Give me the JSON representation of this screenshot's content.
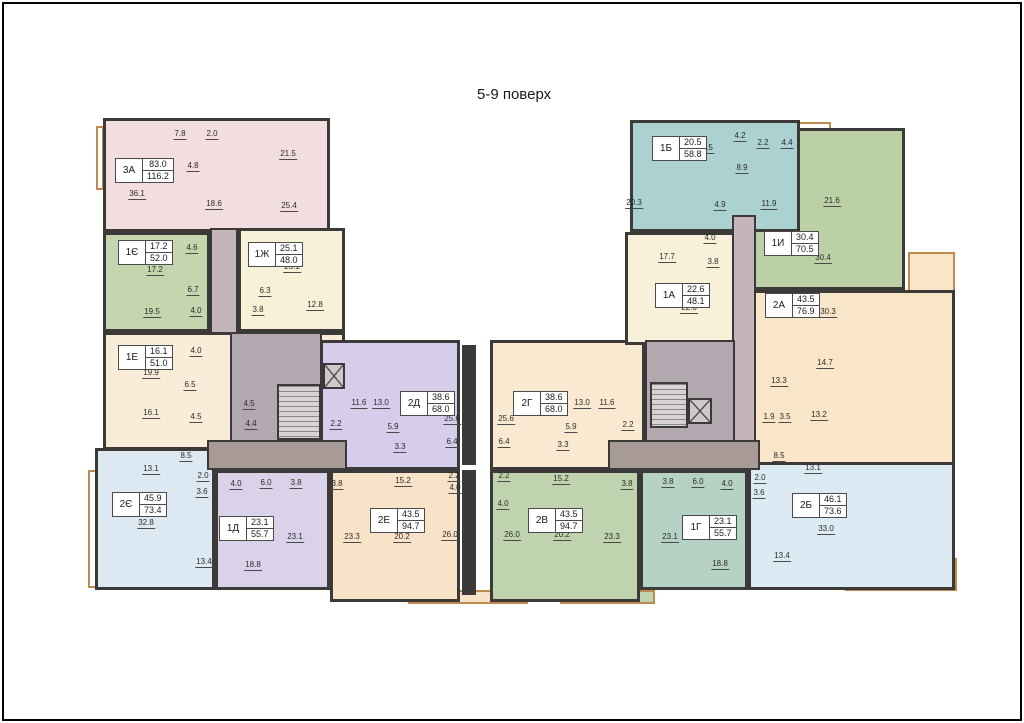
{
  "title": "5-9 поверх",
  "wall_color": "#3c3a39",
  "balcony_color": "#c08a4e",
  "apartments": [
    {
      "id": "3a",
      "code": "3А",
      "living_area": "83.0",
      "total_area": "116.2",
      "color": "#f2dede",
      "rect": [
        103,
        118,
        227,
        114
      ],
      "label_pos": [
        115,
        158
      ],
      "rooms": [
        {
          "v": "7.8",
          "x": 180,
          "y": 134
        },
        {
          "v": "2.0",
          "x": 212,
          "y": 134
        },
        {
          "v": "21.5",
          "x": 288,
          "y": 154
        },
        {
          "v": "4.8",
          "x": 193,
          "y": 166
        },
        {
          "v": "36.1",
          "x": 137,
          "y": 194
        },
        {
          "v": "18.6",
          "x": 214,
          "y": 204
        },
        {
          "v": "25.4",
          "x": 289,
          "y": 206
        }
      ]
    },
    {
      "id": "1ie",
      "code": "1Є",
      "living_area": "17.2",
      "total_area": "52.0",
      "color": "#c3d6ad",
      "rect": [
        103,
        232,
        107,
        100
      ],
      "label_pos": [
        118,
        240
      ],
      "rooms": [
        {
          "v": "4.6",
          "x": 192,
          "y": 248
        },
        {
          "v": "17.2",
          "x": 155,
          "y": 270
        },
        {
          "v": "6.7",
          "x": 193,
          "y": 290
        },
        {
          "v": "19.5",
          "x": 152,
          "y": 312
        },
        {
          "v": "4.0",
          "x": 196,
          "y": 311
        }
      ]
    },
    {
      "id": "1zh",
      "code": "1Ж",
      "living_area": "25.1",
      "total_area": "48.0",
      "color": "#f7f1d7",
      "rect": [
        238,
        228,
        107,
        104
      ],
      "label_pos": [
        248,
        242
      ],
      "rooms": [
        {
          "v": "25.1",
          "x": 292,
          "y": 267
        },
        {
          "v": "6.3",
          "x": 265,
          "y": 291
        },
        {
          "v": "3.8",
          "x": 258,
          "y": 310
        },
        {
          "v": "12.8",
          "x": 315,
          "y": 305
        }
      ]
    },
    {
      "id": "1e",
      "code": "1Е",
      "living_area": "16.1",
      "total_area": "51.0",
      "color": "#f9edda",
      "rect": [
        103,
        332,
        242,
        118
      ],
      "label_pos": [
        118,
        345
      ],
      "rooms": [
        {
          "v": "4.0",
          "x": 196,
          "y": 351
        },
        {
          "v": "19.9",
          "x": 151,
          "y": 373
        },
        {
          "v": "6.5",
          "x": 190,
          "y": 385
        },
        {
          "v": "16.1",
          "x": 151,
          "y": 413
        },
        {
          "v": "4.5",
          "x": 196,
          "y": 417
        }
      ]
    },
    {
      "id": "2ie",
      "code": "2Є",
      "living_area": "45.9",
      "total_area": "73.4",
      "color": "#dce8f2",
      "rect": [
        95,
        448,
        120,
        142
      ],
      "label_pos": [
        112,
        492
      ],
      "rooms": [
        {
          "v": "8.5",
          "x": 186,
          "y": 456
        },
        {
          "v": "13.1",
          "x": 151,
          "y": 469
        },
        {
          "v": "2.0",
          "x": 203,
          "y": 476
        },
        {
          "v": "3.6",
          "x": 202,
          "y": 492
        },
        {
          "v": "32.8",
          "x": 146,
          "y": 523
        },
        {
          "v": "13.4",
          "x": 204,
          "y": 562
        }
      ]
    },
    {
      "id": "1d",
      "code": "1Д",
      "living_area": "23.1",
      "total_area": "55.7",
      "color": "#d9d2e9",
      "rect": [
        215,
        470,
        115,
        120
      ],
      "label_pos": [
        219,
        516
      ],
      "rooms": [
        {
          "v": "4.0",
          "x": 236,
          "y": 484
        },
        {
          "v": "6.0",
          "x": 266,
          "y": 483
        },
        {
          "v": "3.8",
          "x": 296,
          "y": 483
        },
        {
          "v": "23.1",
          "x": 295,
          "y": 537
        },
        {
          "v": "18.8",
          "x": 253,
          "y": 565
        }
      ]
    },
    {
      "id": "2e",
      "code": "2Е",
      "living_area": "43.5",
      "total_area": "94.7",
      "color": "#f8e2c8",
      "rect": [
        330,
        470,
        130,
        132
      ],
      "label_pos": [
        370,
        508
      ],
      "rooms": [
        {
          "v": "3.8",
          "x": 337,
          "y": 484
        },
        {
          "v": "15.2",
          "x": 403,
          "y": 481
        },
        {
          "v": "2.2",
          "x": 454,
          "y": 476
        },
        {
          "v": "4.0",
          "x": 455,
          "y": 488
        },
        {
          "v": "23.3",
          "x": 352,
          "y": 537
        },
        {
          "v": "20.2",
          "x": 402,
          "y": 537
        },
        {
          "v": "26.0",
          "x": 450,
          "y": 535
        }
      ]
    },
    {
      "id": "2d",
      "code": "2Д",
      "living_area": "38.6",
      "total_area": "68.0",
      "color": "#d5cdea",
      "rect": [
        320,
        340,
        140,
        130
      ],
      "label_pos": [
        400,
        391
      ],
      "rooms": [
        {
          "v": "11.6",
          "x": 359,
          "y": 403
        },
        {
          "v": "13.0",
          "x": 381,
          "y": 403
        },
        {
          "v": "25.6",
          "x": 452,
          "y": 419
        },
        {
          "v": "5.9",
          "x": 393,
          "y": 427
        },
        {
          "v": "3.3",
          "x": 400,
          "y": 447
        },
        {
          "v": "6.4",
          "x": 452,
          "y": 442
        }
      ]
    },
    {
      "id": "2g",
      "code": "2Г",
      "living_area": "38.6",
      "total_area": "68.0",
      "color": "#f9e9d0",
      "rect": [
        490,
        340,
        155,
        130
      ],
      "label_pos": [
        513,
        391
      ],
      "rooms": [
        {
          "v": "25.6",
          "x": 506,
          "y": 419
        },
        {
          "v": "13.0",
          "x": 582,
          "y": 403
        },
        {
          "v": "11.6",
          "x": 607,
          "y": 403
        },
        {
          "v": "5.9",
          "x": 571,
          "y": 427
        },
        {
          "v": "6.4",
          "x": 504,
          "y": 442
        },
        {
          "v": "3.3",
          "x": 563,
          "y": 445
        }
      ]
    },
    {
      "id": "2v",
      "code": "2В",
      "living_area": "43.5",
      "total_area": "94.7",
      "color": "#bed3ae",
      "rect": [
        490,
        470,
        150,
        132
      ],
      "label_pos": [
        528,
        508
      ],
      "rooms": [
        {
          "v": "2.2",
          "x": 504,
          "y": 476
        },
        {
          "v": "4.0",
          "x": 503,
          "y": 504
        },
        {
          "v": "15.2",
          "x": 561,
          "y": 479
        },
        {
          "v": "26.0",
          "x": 512,
          "y": 535
        },
        {
          "v": "20.2",
          "x": 562,
          "y": 535
        },
        {
          "v": "23.3",
          "x": 612,
          "y": 537
        },
        {
          "v": "3.8",
          "x": 627,
          "y": 484
        }
      ]
    },
    {
      "id": "1g",
      "code": "1Г",
      "living_area": "23.1",
      "total_area": "55.7",
      "color": "#b5d2c4",
      "rect": [
        640,
        470,
        108,
        120
      ],
      "label_pos": [
        682,
        515
      ],
      "rooms": [
        {
          "v": "3.8",
          "x": 668,
          "y": 482
        },
        {
          "v": "6.0",
          "x": 698,
          "y": 482
        },
        {
          "v": "4.0",
          "x": 727,
          "y": 484
        },
        {
          "v": "23.1",
          "x": 670,
          "y": 537
        },
        {
          "v": "18.8",
          "x": 720,
          "y": 564
        }
      ]
    },
    {
      "id": "2b",
      "code": "2Б",
      "living_area": "46.1",
      "total_area": "73.6",
      "color": "#dcebf3",
      "rect": [
        748,
        452,
        207,
        138
      ],
      "label_pos": [
        792,
        493
      ],
      "rooms": [
        {
          "v": "8.5",
          "x": 779,
          "y": 456
        },
        {
          "v": "13.1",
          "x": 813,
          "y": 468
        },
        {
          "v": "2.0",
          "x": 760,
          "y": 478
        },
        {
          "v": "3.6",
          "x": 759,
          "y": 493
        },
        {
          "v": "33.0",
          "x": 826,
          "y": 529
        },
        {
          "v": "13.4",
          "x": 782,
          "y": 556
        }
      ]
    },
    {
      "id": "2a",
      "code": "2А",
      "living_area": "43.5",
      "total_area": "76.9",
      "color": "#f9e6c9",
      "rect": [
        748,
        290,
        207,
        175
      ],
      "label_pos": [
        765,
        293
      ],
      "rooms": [
        {
          "v": "30.3",
          "x": 828,
          "y": 312
        },
        {
          "v": "14.7",
          "x": 825,
          "y": 363
        },
        {
          "v": "13.3",
          "x": 779,
          "y": 381
        },
        {
          "v": "1.9",
          "x": 769,
          "y": 417
        },
        {
          "v": "3.5",
          "x": 785,
          "y": 417
        },
        {
          "v": "13.2",
          "x": 819,
          "y": 415
        }
      ]
    },
    {
      "id": "1a",
      "code": "1А",
      "living_area": "22.6",
      "total_area": "48.1",
      "color": "#f8f0d9",
      "rect": [
        625,
        232,
        123,
        113
      ],
      "label_pos": [
        655,
        283
      ],
      "rooms": [
        {
          "v": "17.7",
          "x": 667,
          "y": 257
        },
        {
          "v": "4.0",
          "x": 710,
          "y": 238
        },
        {
          "v": "3.8",
          "x": 713,
          "y": 262
        },
        {
          "v": "22.6",
          "x": 689,
          "y": 308
        }
      ]
    },
    {
      "id": "1i",
      "code": "1И",
      "living_area": "30.4",
      "total_area": "70.5",
      "color": "#bcd0a6",
      "rect": [
        748,
        128,
        157,
        162
      ],
      "label_pos": [
        764,
        231
      ],
      "rooms": [
        {
          "v": "2.2",
          "x": 763,
          "y": 143
        },
        {
          "v": "4.4",
          "x": 787,
          "y": 143
        },
        {
          "v": "11.9",
          "x": 769,
          "y": 204
        },
        {
          "v": "21.6",
          "x": 832,
          "y": 201
        },
        {
          "v": "30.4",
          "x": 823,
          "y": 258
        }
      ]
    },
    {
      "id": "1b",
      "code": "1Б",
      "living_area": "20.5",
      "total_area": "58.8",
      "color": "#abd1d1",
      "rect": [
        630,
        120,
        170,
        112
      ],
      "label_pos": [
        652,
        136
      ],
      "rooms": [
        {
          "v": "20.5",
          "x": 705,
          "y": 148
        },
        {
          "v": "4.2",
          "x": 740,
          "y": 136
        },
        {
          "v": "8.9",
          "x": 742,
          "y": 168
        },
        {
          "v": "20.3",
          "x": 634,
          "y": 203
        },
        {
          "v": "4.9",
          "x": 720,
          "y": 205
        }
      ]
    }
  ],
  "common_areas": [
    {
      "id": "corridor-left",
      "type": "corridor",
      "color": "#c6b4bc",
      "rect": [
        210,
        228,
        28,
        106
      ]
    },
    {
      "id": "corridor-right",
      "type": "corridor",
      "color": "#c6b4bc",
      "rect": [
        732,
        215,
        24,
        245
      ]
    },
    {
      "id": "lobby-left",
      "type": "lobby",
      "color": "#b3a8b0",
      "rect": [
        230,
        332,
        92,
        110
      ]
    },
    {
      "id": "lobby-right",
      "type": "lobby",
      "color": "#b3a8b0",
      "rect": [
        645,
        340,
        90,
        102
      ]
    },
    {
      "id": "vestibule-left",
      "type": "vestibule",
      "color": "#a89a94",
      "rect": [
        207,
        440,
        140,
        30
      ]
    },
    {
      "id": "vestibule-right",
      "type": "vestibule",
      "color": "#a89a94",
      "rect": [
        608,
        440,
        152,
        30
      ]
    }
  ],
  "stairs": [
    {
      "id": "stair-left",
      "rect": [
        277,
        384,
        44,
        56
      ]
    },
    {
      "id": "stair-right",
      "rect": [
        650,
        382,
        38,
        46
      ]
    }
  ],
  "elevators": [
    {
      "id": "elevator-left",
      "rect": [
        323,
        363,
        22,
        26
      ]
    },
    {
      "id": "elevator-right",
      "rect": [
        688,
        398,
        24,
        26
      ]
    }
  ],
  "walls": [
    {
      "id": "core-wall-center-upper",
      "rect": [
        462,
        345,
        14,
        120
      ]
    },
    {
      "id": "core-wall-center-lower",
      "rect": [
        462,
        470,
        14,
        125
      ]
    }
  ],
  "common_rooms": [
    {
      "v": "4.5",
      "x": 249,
      "y": 404
    },
    {
      "v": "4.4",
      "x": 251,
      "y": 424
    },
    {
      "v": "2.2",
      "x": 336,
      "y": 424
    },
    {
      "v": "2.2",
      "x": 628,
      "y": 425
    }
  ],
  "balconies": [
    {
      "id": "loggia-left-cross",
      "rect": [
        175,
        228,
        32,
        62
      ],
      "fill": "#c3d6ad",
      "crossed": true
    },
    {
      "id": "balcony-left-edge",
      "rect": [
        88,
        470,
        11,
        118
      ],
      "fill": "#ffffff",
      "crossed": false
    },
    {
      "id": "balcony-3a-left",
      "rect": [
        96,
        126,
        8,
        64
      ],
      "fill": "#ffffff",
      "crossed": false
    },
    {
      "id": "balcony-bottom-center-left",
      "rect": [
        408,
        590,
        120,
        14
      ],
      "fill": "#f8e2c8",
      "crossed": false
    },
    {
      "id": "balcony-bottom-center-right",
      "rect": [
        560,
        590,
        95,
        14
      ],
      "fill": "#bed3ae",
      "crossed": false
    },
    {
      "id": "balcony-2b-corner",
      "rect": [
        845,
        558,
        112,
        33
      ],
      "fill": "#dcebf3",
      "crossed": false
    },
    {
      "id": "balcony-2a-right",
      "rect": [
        908,
        252,
        47,
        92
      ],
      "fill": "#f9e6c9",
      "crossed": false
    },
    {
      "id": "balcony-1b-top",
      "rect": [
        795,
        122,
        36,
        14
      ],
      "fill": "#ffffff",
      "crossed": true
    },
    {
      "id": "shaft-left-1",
      "rect": [
        291,
        468,
        22,
        18
      ],
      "fill": "#ffffff",
      "crossed": true
    },
    {
      "id": "shaft-left-2",
      "rect": [
        321,
        468,
        22,
        18
      ],
      "fill": "#ffffff",
      "crossed": true
    },
    {
      "id": "shaft-right-1",
      "rect": [
        618,
        470,
        20,
        18
      ],
      "fill": "#ffffff",
      "crossed": true
    },
    {
      "id": "shaft-right-2",
      "rect": [
        646,
        470,
        20,
        18
      ],
      "fill": "#ffffff",
      "crossed": true
    }
  ]
}
